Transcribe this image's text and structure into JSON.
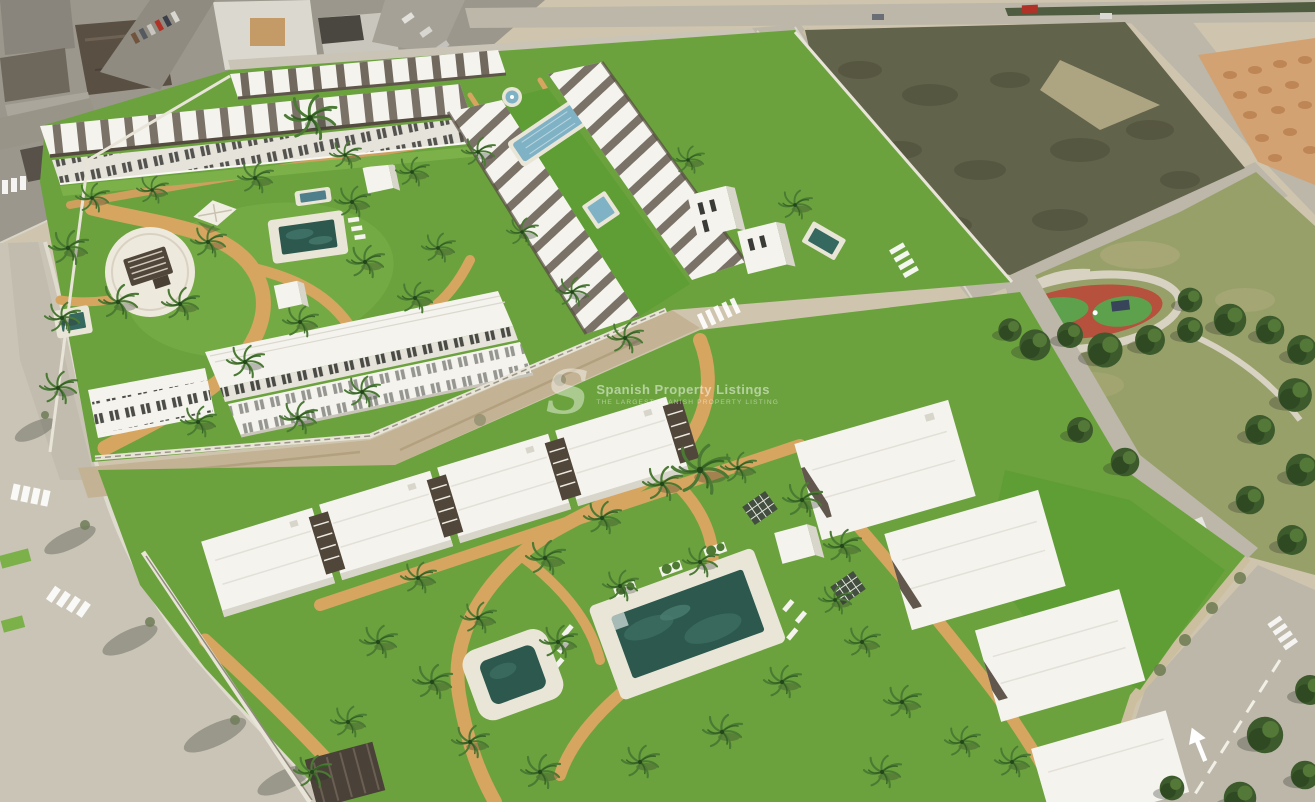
{
  "meta": {
    "description": "Aerial 3D architectural render of a new-build residential complex: white townhouses and apartment blocks around communal lawns with palm trees, curving sand-coloured paths and swimming pools, beside an existing town (top left), an empty scrub plot (top right), orange dirt mounds (far top right) and a public park with a red playground track (right). Streets with crosswalks border the site.",
    "width_px": 1315,
    "height_px": 802
  },
  "watermark": {
    "logo_letter": "S",
    "title": "Spanish Property Listings",
    "subtitle": "THE LARGEST SPANISH PROPERTY LISTING"
  },
  "colors": {
    "sand": "#cfc5ae",
    "road": "#bcb7a9",
    "roadLight": "#c9c4b6",
    "sidewalk": "#dfdbce",
    "asphalt": "#9b978c",
    "lawn": "#6ba23d",
    "lawnBright": "#5f9e35",
    "lawnLight": "#7cb14a",
    "path": "#d6a560",
    "pathPale": "#cf9f5e",
    "building": "#f4f3ee",
    "buildingShade": "#d8d5cb",
    "facade": "#e6e3da",
    "pergola": "#51463a",
    "poolDark": "#2c584e",
    "poolLight": "#7fb2c4",
    "deck": "#e9e6d8",
    "scrub": "#62634b",
    "dirt": "#d3a273",
    "dirtMound": "#b97f4e",
    "park": "#98a06a",
    "tree": "#3c5a2c",
    "treeLight": "#547837",
    "playgroundRed": "#b5513c",
    "playgroundGreen": "#5da14d",
    "wall": "#e8e4d8",
    "dirtStrip": "#c3b394",
    "shadow": "rgba(45,50,40,0.3)",
    "watermark": "rgba(255,255,255,0.5)",
    "carRed": "#b03226"
  }
}
